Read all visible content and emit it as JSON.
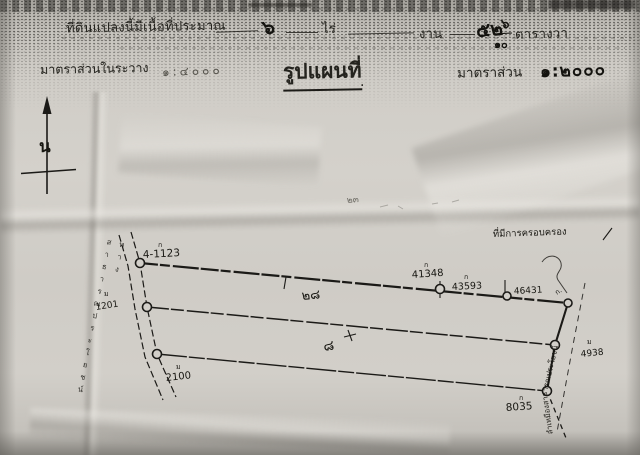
{
  "document": {
    "area_statement": {
      "prefix": "ที่ดินแปลงนี้มีเนื้อที่ประมาณ",
      "rai_value": "๖",
      "rai_unit": "ไร่",
      "ngan_unit": "งาน",
      "sq_wa_value": "๕๒",
      "sq_wa_fraction_numerator": "๖",
      "sq_wa_fraction_denominator": "๑๐",
      "sq_wa_unit": "ตารางวา"
    },
    "scale_line": {
      "sheet_scale_label": "มาตราส่วนในระวาง",
      "sheet_scale_value": "๑:๔๐๐๐",
      "map_title": "รูปแผนที่",
      "map_title_period": ".",
      "map_scale_label": "มาตราส่วน",
      "map_scale_value": "๑:๒๐๐๐"
    },
    "compass_north_letter": "น",
    "map": {
      "upper_parcel_number": "๒๘",
      "lower_parcel_number": "๘",
      "possession_note": "ที่มีการครอบครอง",
      "road_label": "ทางสาธารณประโยชน์",
      "canal_label": "ลำเหมืองสาธารณประโยชน์",
      "pencil_note": "๒๓",
      "posts": [
        {
          "id": "4-1123",
          "mark": "ก"
        },
        {
          "id": "41348",
          "mark": "ก"
        },
        {
          "id": "43593",
          "mark": "ก"
        },
        {
          "id": "46431",
          "mark": "ก."
        },
        {
          "id": "1201",
          "mark": "ม"
        },
        {
          "id": "2100",
          "mark": "ม"
        },
        {
          "id": "8035",
          "mark": "ก"
        },
        {
          "id": "4938",
          "mark": "ม"
        }
      ]
    },
    "ink_color": "#1b1a17",
    "paper_color": "#d2cfc9"
  }
}
